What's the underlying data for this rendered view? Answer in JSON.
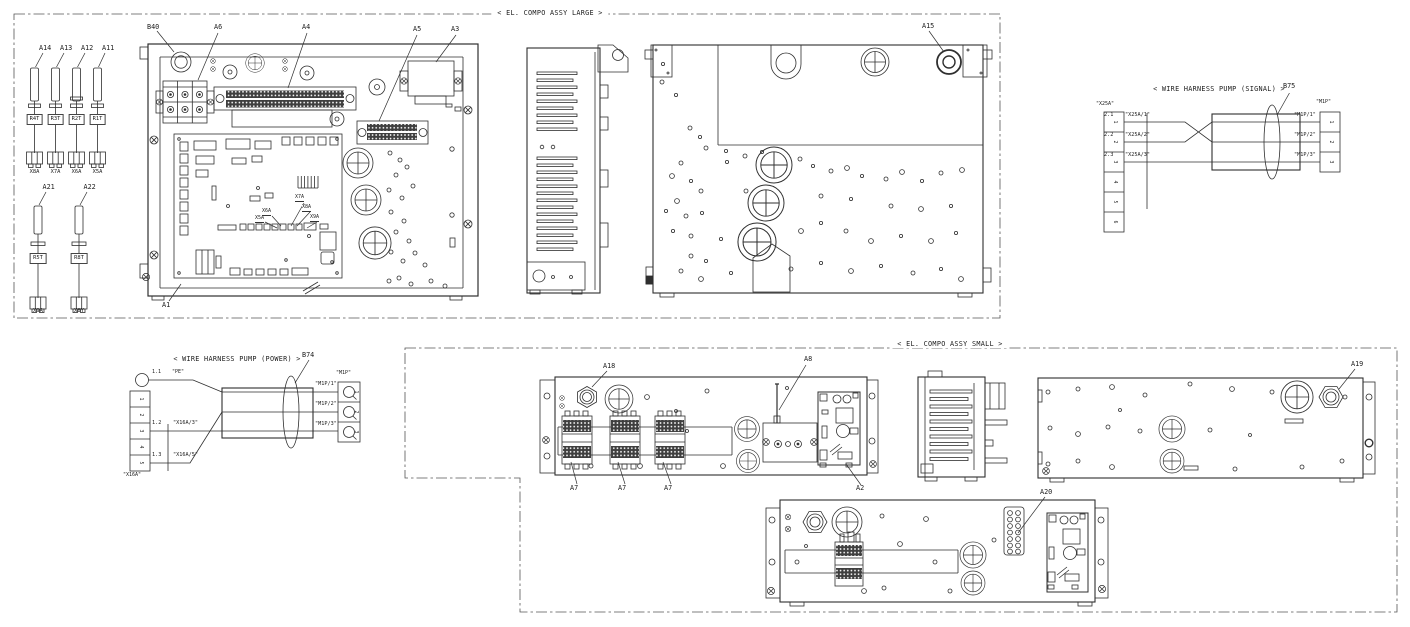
{
  "canvas": {
    "background": "#ffffff",
    "line_color": "#2f2f2f"
  },
  "sections": {
    "large_title": "< EL. COMPO ASSY LARGE >",
    "small_title": "< EL. COMPO ASSY SMALL >"
  },
  "labels": {
    "a1": "A1",
    "a2": "A2",
    "a3": "A3",
    "a4": "A4",
    "a5": "A5",
    "a6": "A6",
    "a7": "A7",
    "a8": "A8",
    "a11": "A11",
    "a12": "A12",
    "a13": "A13",
    "a14": "A14",
    "a15": "A15",
    "a18": "A18",
    "a19": "A19",
    "a20": "A20",
    "a21": "A21",
    "a22": "A22",
    "b40": "B40",
    "b74": "B74",
    "b75": "B75"
  },
  "pigtails_top": [
    {
      "part": "A14",
      "relay": "R4T",
      "connector": "X8A"
    },
    {
      "part": "A13",
      "relay": "R3T",
      "connector": "X7A"
    },
    {
      "part": "A12",
      "relay": "R2T",
      "connector": "X6A"
    },
    {
      "part": "A11",
      "relay": "R1T",
      "connector": "X5A"
    }
  ],
  "pigtails_bottom": [
    {
      "part": "A21",
      "relay": "R5T",
      "connector": "X9A"
    },
    {
      "part": "A22",
      "relay": "R8T",
      "connector": "X8Y"
    }
  ],
  "pcb_connectors": [
    "X5A",
    "X6A",
    "X7A",
    "X8A",
    "X9A"
  ],
  "harness_signal": {
    "title": "< WIRE HARNESS PUMP (SIGNAL) >",
    "part": "B75",
    "left_name": "\"X25A\"",
    "right_name": "\"M1P\"",
    "left_pins": [
      "1",
      "2",
      "3",
      "4",
      "5",
      "6"
    ],
    "right_pins": [
      "1",
      "2",
      "3"
    ],
    "rows": [
      {
        "num": "2.1",
        "from": "\"X25A/1\"",
        "to": "\"M1P/1\""
      },
      {
        "num": "2.2",
        "from": "\"X25A/2\"",
        "to": "\"M1P/2\""
      },
      {
        "num": "2.3",
        "from": "\"X25A/3\"",
        "to": "\"M1P/3\""
      }
    ]
  },
  "harness_power": {
    "title": "< WIRE HARNESS PUMP (POWER) >",
    "part": "B74",
    "left_name": "\"X16A\"",
    "right_name": "\"M1P\"",
    "left_pins": [
      "1",
      "2",
      "3",
      "4",
      "5"
    ],
    "right_pins": [
      "1",
      "2",
      "3"
    ],
    "pe_row": {
      "num": "1.1",
      "from": "\"PE\""
    },
    "rows": [
      {
        "num": "1.2",
        "from": "\"X16A/3\""
      },
      {
        "num": "1.3",
        "from": "\"X16A/5\""
      }
    ],
    "to_labels": [
      "\"M1P/1\"",
      "\"M1P/2\"",
      "\"M1P/3\""
    ]
  }
}
